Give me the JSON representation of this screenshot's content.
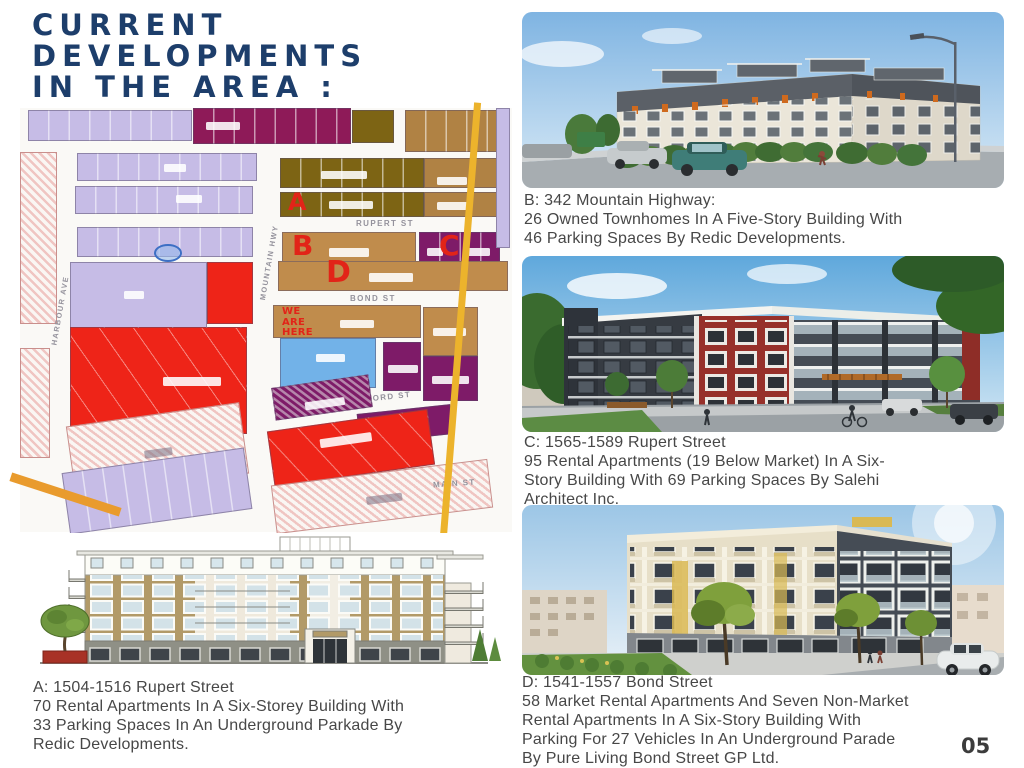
{
  "slide": {
    "page_number": "05"
  },
  "title": "CURRENT\nDEVELOPMENTS\nIN THE AREA :",
  "map": {
    "street_labels": {
      "rupert": "RUPERT ST",
      "bond": "BOND ST",
      "oxford": "OXFORD ST",
      "main": "MAIN ST",
      "mountain_hwy": "MOUNTAIN HWY",
      "harbour_ave": "HARBOUR AVE"
    },
    "markers": {
      "a": "A",
      "b": "B",
      "c": "C",
      "d": "D",
      "we_are_here": "WE\nARE\nHERE"
    }
  },
  "listings": {
    "a": {
      "caption": "A: 1504-1516 Rupert Street\n70 Rental Apartments In A Six-Storey Building With\n33 Parking Spaces In An Underground Parkade By\nRedic Developments."
    },
    "b": {
      "caption": "B: 342 Mountain Highway:\n26 Owned Townhomes In A Five-Story Building With\n46 Parking Spaces By Redic Developments."
    },
    "c": {
      "caption": "C: 1565-1589 Rupert Street\n95 Rental Apartments (19 Below Market) In A Six-\nStory Building With 69 Parking Spaces By Salehi\nArchitect Inc."
    },
    "d": {
      "caption": "D: 1541-1557 Bond Street\n58 Market Rental Apartments And Seven Non-Market\nRental Apartments In A Six-Story Building With\nParking For 27 Vehicles In An Underground Parade\nBy Pure Living Bond Street GP Ltd."
    }
  },
  "colors": {
    "title_navy": "#1d3e6b",
    "marker_red": "#e22418",
    "caption_gray": "#474747",
    "map_red": "#ee2418",
    "map_purple": "#7e1b68",
    "map_tan": "#c08c4c",
    "map_lavender": "#c6bce6"
  }
}
